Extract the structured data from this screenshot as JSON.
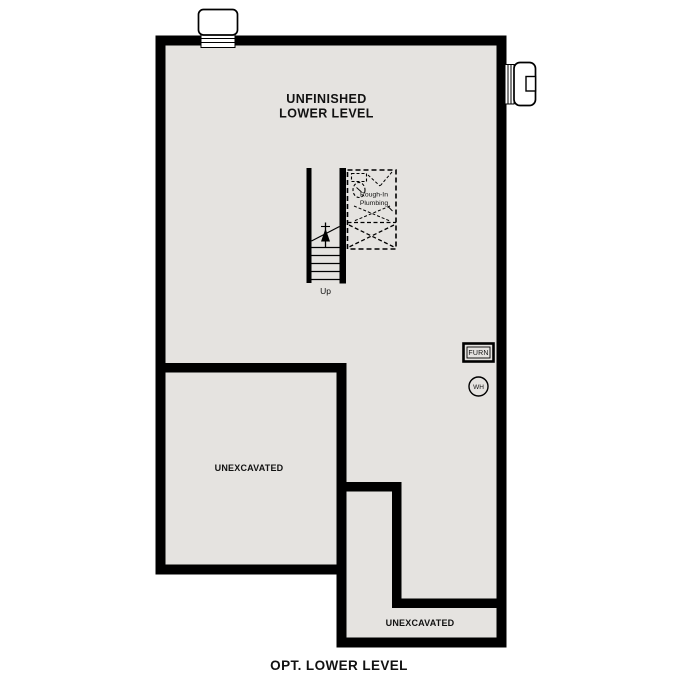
{
  "plan": {
    "caption": "OPT. LOWER LEVEL",
    "main_area": {
      "label_line1": "UNFINISHED",
      "label_line2": "LOWER LEVEL"
    },
    "unexcavated_left": {
      "label": "UNEXCAVATED"
    },
    "unexcavated_bottom": {
      "label": "UNEXCAVATED"
    },
    "stairs": {
      "up_label": "Up"
    },
    "rough_in_plumbing": {
      "label_line1": "Rough-In",
      "label_line2": "Plumbing"
    },
    "furnace": {
      "label": "FURN"
    },
    "water_heater": {
      "label": "WH"
    },
    "colors": {
      "wall": "#000000",
      "floor": "#e5e3e0",
      "background": "#ffffff",
      "text": "#111111"
    }
  }
}
